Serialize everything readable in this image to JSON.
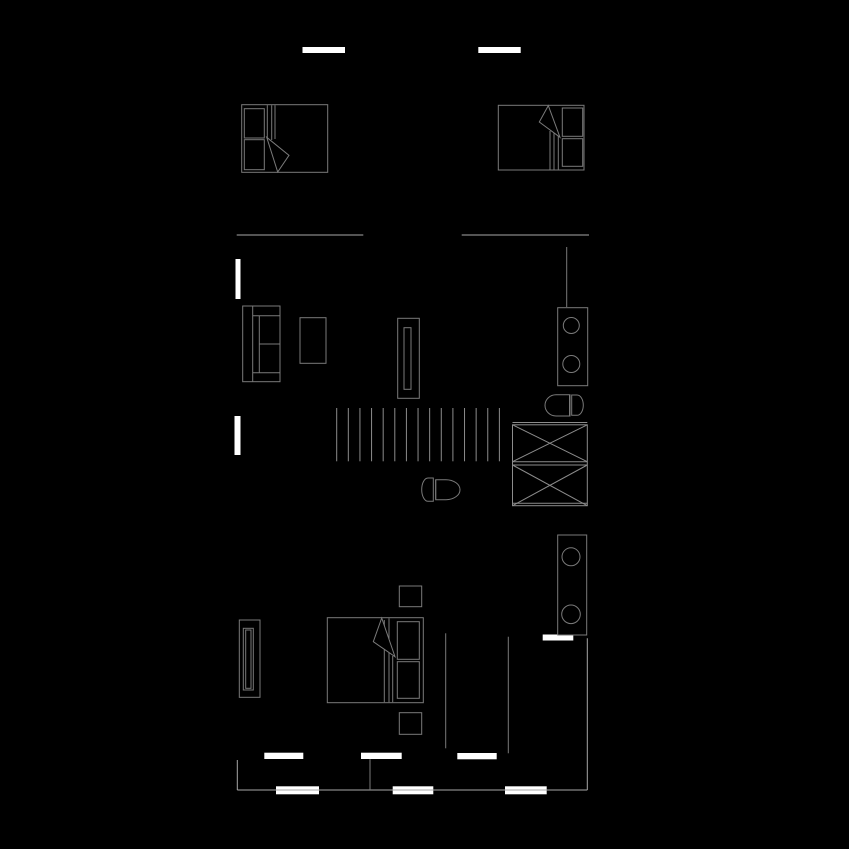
{
  "canvas": {
    "width": 849,
    "height": 849,
    "background": "#000000"
  },
  "palette": {
    "wall_fill": "#ffffff",
    "furniture_line": "#7a7a7a",
    "wall_line": "#a8a8a8",
    "fixture_line": "#8c8c8c",
    "fill_black": "#000000"
  },
  "elements": [
    {
      "name": "wall-segment-top-left",
      "type": "bar",
      "x": 302.5,
      "y": 47,
      "w": 42.5,
      "h": 6
    },
    {
      "name": "wall-segment-top-right",
      "type": "bar",
      "x": 478.3,
      "y": 47,
      "w": 42.4,
      "h": 6
    },
    {
      "name": "wall-segment-left-upper",
      "type": "bar",
      "x": 235.5,
      "y": 259,
      "w": 5,
      "h": 40
    },
    {
      "name": "wall-segment-left-lower",
      "type": "bar",
      "x": 234.5,
      "y": 416,
      "w": 6,
      "h": 39
    },
    {
      "name": "wall-segment-bath-door",
      "type": "bar",
      "x": 542.7,
      "y": 634.5,
      "w": 30.6,
      "h": 6
    },
    {
      "name": "wall-segment-mid-1",
      "type": "bar",
      "x": 264.3,
      "y": 752.7,
      "w": 39,
      "h": 6.3
    },
    {
      "name": "wall-segment-mid-2",
      "type": "bar",
      "x": 361,
      "y": 752.7,
      "w": 40.7,
      "h": 6.3
    },
    {
      "name": "wall-segment-mid-3",
      "type": "bar",
      "x": 457.3,
      "y": 753,
      "w": 39.4,
      "h": 6.3
    },
    {
      "name": "wall-segment-bottom-1",
      "type": "bar",
      "x": 276,
      "y": 786.3,
      "w": 43,
      "h": 8
    },
    {
      "name": "wall-segment-bottom-2",
      "type": "bar",
      "x": 392.7,
      "y": 786.3,
      "w": 40.6,
      "h": 8
    },
    {
      "name": "wall-segment-bottom-3",
      "type": "bar",
      "x": 505,
      "y": 786.3,
      "w": 41.7,
      "h": 8
    },
    {
      "name": "upper-floor-edge-left",
      "type": "line",
      "x1": 236.7,
      "y1": 235,
      "x2": 363.3,
      "y2": 235,
      "color": "wall_line"
    },
    {
      "name": "upper-floor-edge-right",
      "type": "line",
      "x1": 461.7,
      "y1": 235,
      "x2": 589,
      "y2": 235,
      "color": "wall_line"
    },
    {
      "name": "plumbing-wall",
      "type": "line",
      "x1": 566.7,
      "y1": 247,
      "x2": 566.7,
      "y2": 307
    },
    {
      "name": "interior-wall-left",
      "type": "line",
      "x1": 445.7,
      "y1": 633.3,
      "x2": 445.7,
      "y2": 748.3
    },
    {
      "name": "interior-wall-right",
      "type": "line",
      "x1": 508.3,
      "y1": 636.7,
      "x2": 508.3,
      "y2": 753.3
    },
    {
      "name": "exterior-wall-right",
      "type": "line",
      "x1": 587.3,
      "y1": 638.3,
      "x2": 587.3,
      "y2": 790,
      "color": "wall_line"
    },
    {
      "name": "exterior-wall-bottom",
      "type": "line",
      "x1": 237.3,
      "y1": 790,
      "x2": 587.3,
      "y2": 790,
      "color": "wall_line"
    },
    {
      "name": "exterior-wall-left-corner",
      "type": "line",
      "x1": 237.3,
      "y1": 760,
      "x2": 237.3,
      "y2": 790,
      "color": "wall_line"
    },
    {
      "name": "door-jamb",
      "type": "line",
      "x1": 370,
      "y1": 759.3,
      "x2": 370,
      "y2": 790
    },
    {
      "name": "staircase-treads",
      "type": "vlines",
      "x0": 336.7,
      "step": 11.62,
      "count": 15,
      "y1": 408,
      "y2": 461.3,
      "color": "fixture_line"
    },
    {
      "name": "washer-dryer-outline",
      "type": "rect",
      "x": 512.5,
      "y": 424.8,
      "w": 74.8,
      "h": 80.9,
      "color": "fixture_line"
    },
    {
      "name": "washer-dryer-top-edge",
      "type": "line",
      "x1": 512.5,
      "y1": 422.5,
      "x2": 587.3,
      "y2": 422.5,
      "color": "fixture_line"
    },
    {
      "name": "washer-dryer-divider-a",
      "type": "line",
      "x1": 512.5,
      "y1": 461.7,
      "x2": 587.3,
      "y2": 461.7,
      "color": "fixture_line"
    },
    {
      "name": "washer-dryer-divider-b",
      "type": "line",
      "x1": 512.5,
      "y1": 465,
      "x2": 587.3,
      "y2": 465,
      "color": "fixture_line"
    },
    {
      "name": "washer-dryer-bottom-edge",
      "type": "line",
      "x1": 512.5,
      "y1": 503.2,
      "x2": 587.3,
      "y2": 503.2,
      "color": "fixture_line"
    },
    {
      "name": "washer-cross-1",
      "type": "line",
      "x1": 512.5,
      "y1": 424.8,
      "x2": 587.3,
      "y2": 461.7,
      "color": "fixture_line"
    },
    {
      "name": "washer-cross-2",
      "type": "line",
      "x1": 512.5,
      "y1": 461.7,
      "x2": 587.3,
      "y2": 424.8,
      "color": "fixture_line"
    },
    {
      "name": "dryer-cross-1",
      "type": "line",
      "x1": 512.5,
      "y1": 465,
      "x2": 587.3,
      "y2": 505.7,
      "color": "fixture_line"
    },
    {
      "name": "dryer-cross-2",
      "type": "line",
      "x1": 512.5,
      "y1": 505.7,
      "x2": 587.3,
      "y2": 465,
      "color": "fixture_line"
    },
    {
      "name": "vanity-upper-counter",
      "type": "rect",
      "x": 557.7,
      "y": 307.7,
      "w": 30,
      "h": 78
    },
    {
      "name": "vanity-upper-sink-1",
      "type": "circle",
      "cx": 571.3,
      "cy": 325.5,
      "r": 8
    },
    {
      "name": "vanity-upper-sink-2",
      "type": "circle",
      "cx": 571.3,
      "cy": 364,
      "r": 8.5
    },
    {
      "name": "toilet-upper-bowl",
      "type": "path",
      "d": "M570,394.8 L556,394.8 A11,10.6 0 0 0 556,416 L570,416 Z"
    },
    {
      "name": "toilet-upper-seat-line",
      "type": "line",
      "x1": 569.5,
      "y1": 395,
      "x2": 569.5,
      "y2": 415.8
    },
    {
      "name": "toilet-upper-tank",
      "type": "path",
      "d": "M571.7,395 L577,395 A6.3,10.15 0 0 1 577,415.3 L571.7,415.3 Z"
    },
    {
      "name": "toilet-mid-tank",
      "type": "path",
      "d": "M433.3,478 L428,478 A6.3,11.65 0 0 0 428,501.3 L433.3,501.3 Z"
    },
    {
      "name": "toilet-mid-seat-line",
      "type": "line",
      "x1": 435.7,
      "y1": 479.7,
      "x2": 435.7,
      "y2": 499.7
    },
    {
      "name": "toilet-mid-bowl",
      "type": "path",
      "d": "M435.7,479.7 L446,479.7 A14,10 0 0 1 446,499.7 L435.7,499.7 Z"
    },
    {
      "name": "vanity-lower-counter",
      "type": "rect",
      "x": 557.7,
      "y": 535,
      "w": 29,
      "h": 100
    },
    {
      "name": "vanity-lower-sink-1",
      "type": "circle",
      "cx": 571,
      "cy": 556.8,
      "r": 9
    },
    {
      "name": "vanity-lower-sink-2",
      "type": "circle",
      "cx": 571,
      "cy": 614.3,
      "r": 9.3
    },
    {
      "name": "bed-1-frame",
      "type": "rect",
      "x": 241.7,
      "y": 104.7,
      "w": 86,
      "h": 67.6
    },
    {
      "name": "bed-1-pillow-1",
      "type": "rect",
      "x": 244.3,
      "y": 108.7,
      "w": 20,
      "h": 29.3
    },
    {
      "name": "bed-1-pillow-2",
      "type": "rect",
      "x": 244.3,
      "y": 139.7,
      "w": 20,
      "h": 30
    },
    {
      "name": "bed-1-sheet-line-1",
      "type": "line",
      "x1": 267.3,
      "y1": 105.2,
      "x2": 267.3,
      "y2": 138
    },
    {
      "name": "bed-1-sheet-line-2",
      "type": "line",
      "x1": 271.7,
      "y1": 105.2,
      "x2": 271.7,
      "y2": 140
    },
    {
      "name": "bed-1-sheet-line-3",
      "type": "line",
      "x1": 275,
      "y1": 105.2,
      "x2": 275,
      "y2": 139
    },
    {
      "name": "bed-1-blanket-fold",
      "type": "polygon",
      "points": "266.7,137.3 289,155.3 277.7,172",
      "fill": "fill_black"
    },
    {
      "name": "bed-2-frame",
      "type": "rect",
      "x": 498.3,
      "y": 105.3,
      "w": 85.7,
      "h": 64.7
    },
    {
      "name": "bed-2-pillow-1",
      "type": "rect",
      "x": 562.3,
      "y": 108,
      "w": 20.4,
      "h": 28.3
    },
    {
      "name": "bed-2-pillow-2",
      "type": "rect",
      "x": 562.3,
      "y": 138.7,
      "w": 20.4,
      "h": 27.6
    },
    {
      "name": "bed-2-sheet-line-1",
      "type": "line",
      "x1": 550,
      "y1": 131,
      "x2": 550,
      "y2": 169.7
    },
    {
      "name": "bed-2-sheet-line-2",
      "type": "line",
      "x1": 554,
      "y1": 133,
      "x2": 554,
      "y2": 169.7
    },
    {
      "name": "bed-2-sheet-line-3",
      "type": "line",
      "x1": 558.3,
      "y1": 135,
      "x2": 558.3,
      "y2": 169.7
    },
    {
      "name": "bed-2-blanket-fold",
      "type": "polygon",
      "points": "548.3,105.6 539.3,122 560,137.3",
      "fill": "fill_black"
    },
    {
      "name": "bed-3-frame",
      "type": "rect",
      "x": 327.3,
      "y": 617.7,
      "w": 96,
      "h": 85
    },
    {
      "name": "bed-3-pillow-1",
      "type": "rect",
      "x": 397.3,
      "y": 621.7,
      "w": 22,
      "h": 37.6
    },
    {
      "name": "bed-3-pillow-2",
      "type": "rect",
      "x": 397.3,
      "y": 661.7,
      "w": 22,
      "h": 36.6
    },
    {
      "name": "bed-3-sheet-line-1",
      "type": "line",
      "x1": 384.3,
      "y1": 620,
      "x2": 384.3,
      "y2": 702.2
    },
    {
      "name": "bed-3-sheet-line-2",
      "type": "line",
      "x1": 389,
      "y1": 618.2,
      "x2": 389,
      "y2": 702.2
    },
    {
      "name": "bed-3-sheet-line-3",
      "type": "line",
      "x1": 392.7,
      "y1": 656,
      "x2": 392.7,
      "y2": 702.2
    },
    {
      "name": "bed-3-blanket-fold",
      "type": "polygon",
      "points": "381.7,618 373.3,641.7 395,656.7",
      "fill": "fill_black"
    },
    {
      "name": "nightstand-upper",
      "type": "rect",
      "x": 399.3,
      "y": 586,
      "w": 22.4,
      "h": 20.7
    },
    {
      "name": "nightstand-lower",
      "type": "rect",
      "x": 399.3,
      "y": 712.7,
      "w": 22.4,
      "h": 21.6
    },
    {
      "name": "wardrobe-outline",
      "type": "rect",
      "x": 239.3,
      "y": 620,
      "w": 20.7,
      "h": 77.3
    },
    {
      "name": "wardrobe-door",
      "type": "rect",
      "x": 243.3,
      "y": 628.3,
      "w": 10,
      "h": 61.7
    },
    {
      "name": "wardrobe-door-inner",
      "type": "rect",
      "x": 245.7,
      "y": 630,
      "w": 5.3,
      "h": 58.3
    },
    {
      "name": "sofa-outline",
      "type": "rect",
      "x": 242.7,
      "y": 306,
      "w": 37.3,
      "h": 75.7
    },
    {
      "name": "sofa-back-edge",
      "type": "line",
      "x1": 252.7,
      "y1": 306,
      "x2": 252.7,
      "y2": 381.7
    },
    {
      "name": "sofa-armrest-top-edge",
      "type": "line",
      "x1": 252.7,
      "y1": 315.7,
      "x2": 280,
      "y2": 315.7
    },
    {
      "name": "sofa-armrest-bottom-edge",
      "type": "line",
      "x1": 252.7,
      "y1": 372.7,
      "x2": 280,
      "y2": 372.7
    },
    {
      "name": "sofa-cushion-edge",
      "type": "line",
      "x1": 259.3,
      "y1": 315.7,
      "x2": 259.3,
      "y2": 372.7
    },
    {
      "name": "sofa-cushion-divider",
      "type": "line",
      "x1": 259.3,
      "y1": 344,
      "x2": 280,
      "y2": 344
    },
    {
      "name": "coffee-table",
      "type": "rect",
      "x": 300,
      "y": 317.7,
      "w": 26,
      "h": 45.6
    },
    {
      "name": "tv-stand",
      "type": "rect",
      "x": 397.7,
      "y": 318.3,
      "w": 21.6,
      "h": 80
    },
    {
      "name": "tv-screen",
      "type": "rect",
      "x": 404,
      "y": 327.7,
      "w": 7,
      "h": 61.6
    }
  ]
}
